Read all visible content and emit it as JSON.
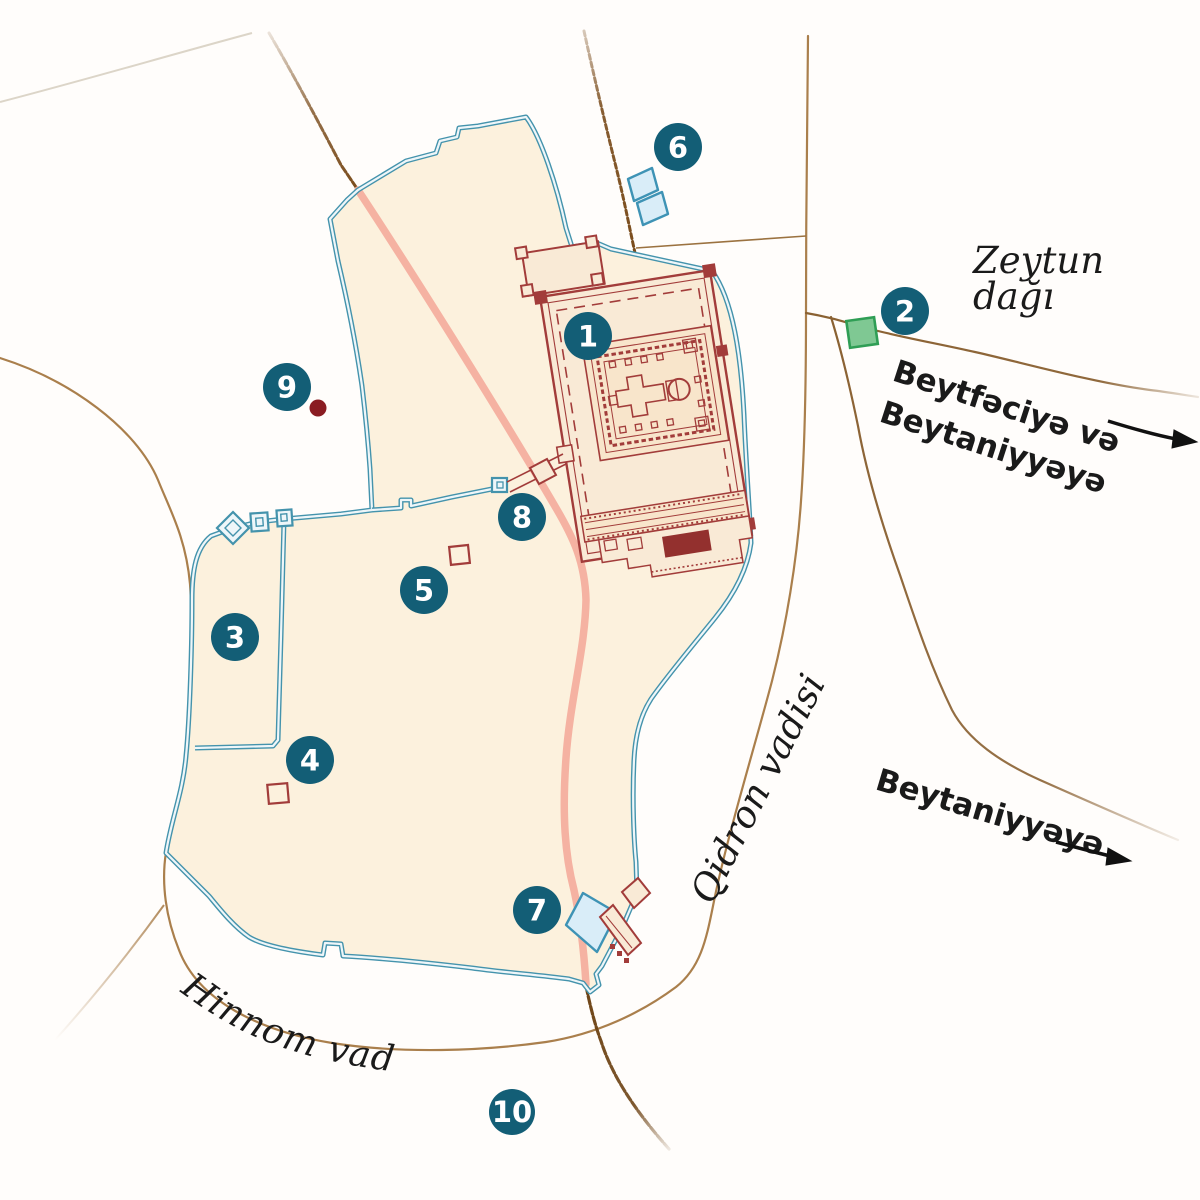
{
  "markers": [
    {
      "label": "1"
    },
    {
      "label": "2"
    },
    {
      "label": "3"
    },
    {
      "label": "4"
    },
    {
      "label": "5"
    },
    {
      "label": "6"
    },
    {
      "label": "7"
    },
    {
      "label": "8"
    },
    {
      "label": "9"
    },
    {
      "label": "10"
    }
  ],
  "labels": {
    "mount_of_olives_line1": "Zeytun",
    "mount_of_olives_line2": "dağı",
    "to_bethphage_line1": "Beytfəciyə və",
    "to_bethphage_line2": "Beytaniyyəyə",
    "to_bethany": "Beytaniyyəyə",
    "kidron_valley": "Qidron vadisi",
    "hinnom_valley": "Hinnom vadisi"
  },
  "colors": {
    "marker": "#135e76",
    "marker_text": "#ffffff",
    "wall": "#4493ac",
    "wall_gap": "#eef6f9",
    "city_fill": "#fcf1dd",
    "temple_red": "#a23c3a",
    "temple_red_dark": "#93302e",
    "temple_fill": "#f9ead6",
    "temple_inner_fill": "#f8e5cb",
    "road_dark": "#7a4c1c",
    "road_medium": "#9b7240",
    "valley": "#aa7f4c",
    "pink_road": "#f5b2a2",
    "pool_fill": "#d9edf8",
    "pool_stroke": "#3e93b5",
    "green_fill": "#7fc893",
    "green_stroke": "#2f9e55",
    "dark_red_dot": "#8a1c22",
    "label_text": "#1a1a1a",
    "arrow": "#111111"
  }
}
